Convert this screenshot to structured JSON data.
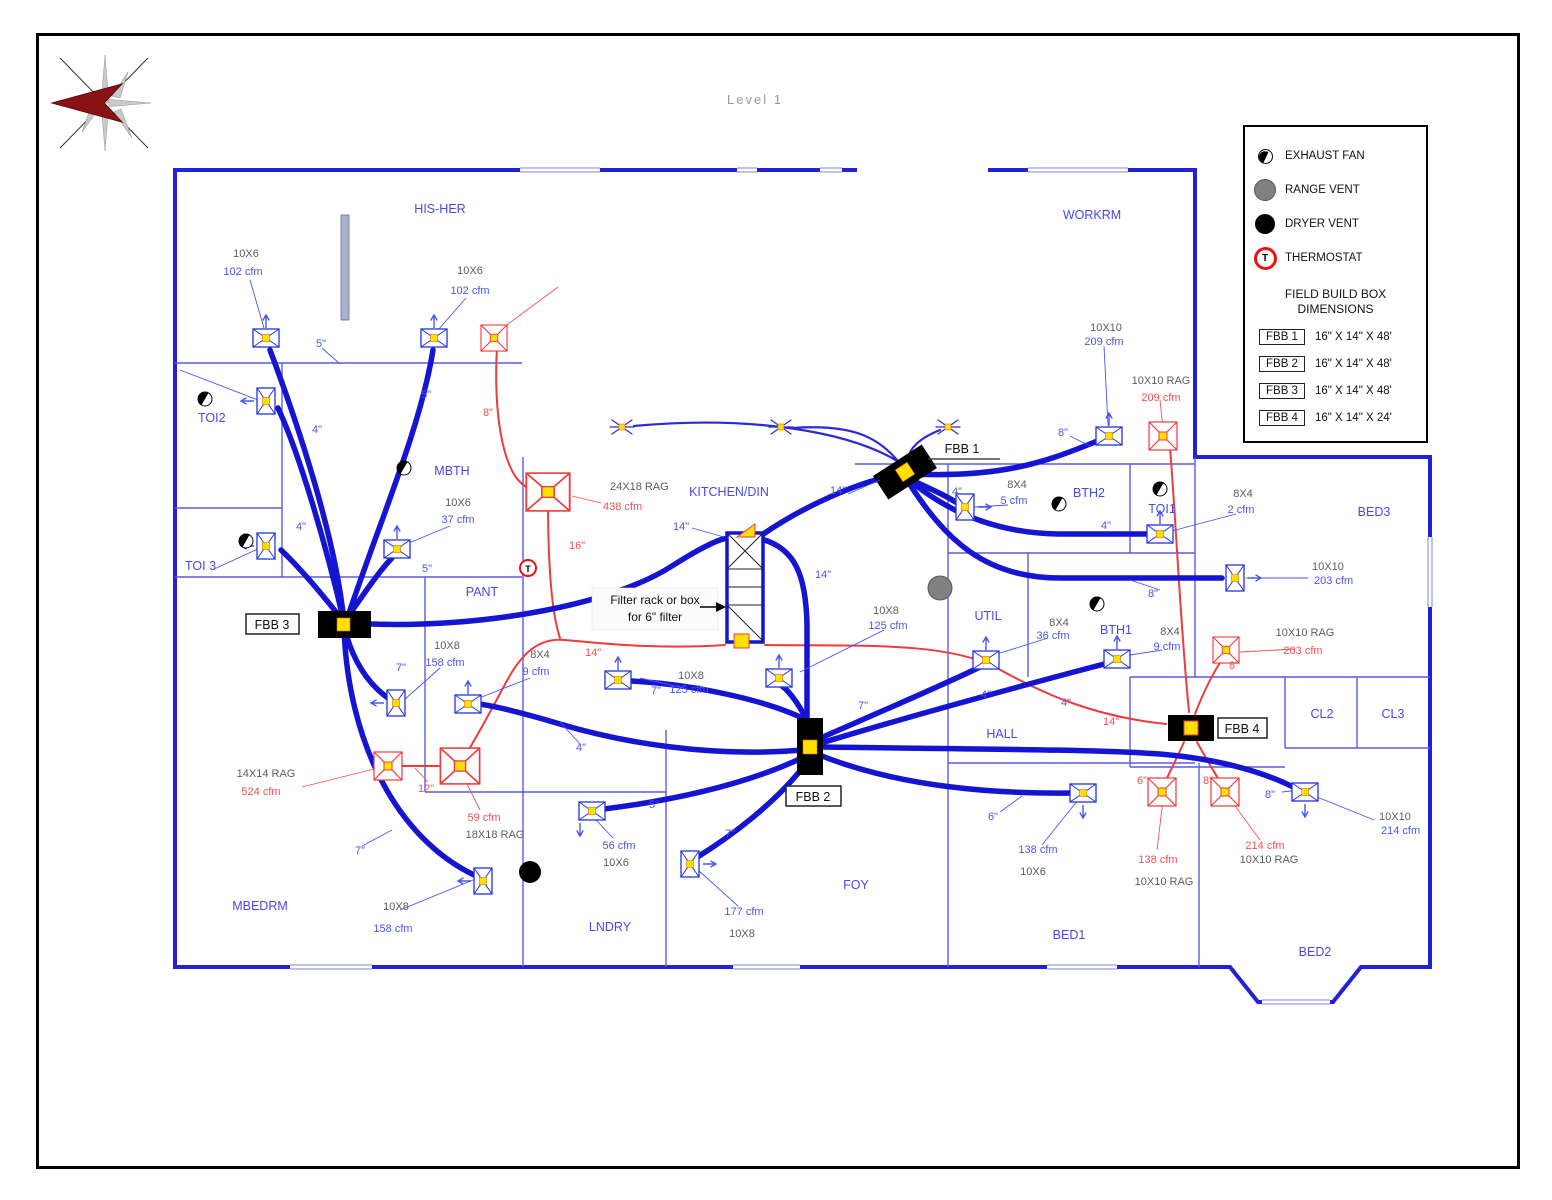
{
  "title": "Level 1",
  "colors": {
    "duct_blue": "#1414d2",
    "wall_blue": "#2121d9",
    "return_red": "#ee3b3b",
    "damper_yellow": "#ffe000"
  },
  "legend": {
    "items": [
      {
        "label": "EXHAUST FAN"
      },
      {
        "label": "RANGE VENT"
      },
      {
        "label": "DRYER VENT"
      },
      {
        "label": "THERMOSTAT"
      }
    ],
    "thermostat_letter": "T",
    "fbb_heading1": "FIELD BUILD BOX",
    "fbb_heading2": "DIMENSIONS",
    "fbb_rows": [
      {
        "tag": "FBB 1",
        "dim": "16\" X 14\" X 48'"
      },
      {
        "tag": "FBB 2",
        "dim": "16\" X 14\" X 48'"
      },
      {
        "tag": "FBB 3",
        "dim": "16\" X 14\" X 48'"
      },
      {
        "tag": "FBB 4",
        "dim": "16\" X 14\" X 24'"
      }
    ]
  },
  "rooms": [
    {
      "name": "HIS-HER"
    },
    {
      "name": "TOI2"
    },
    {
      "name": "TOI 3"
    },
    {
      "name": "MBTH"
    },
    {
      "name": "PANT"
    },
    {
      "name": "MBEDRM"
    },
    {
      "name": "LNDRY"
    },
    {
      "name": "KITCHEN/DIN"
    },
    {
      "name": "WORKRM"
    },
    {
      "name": "BTH2"
    },
    {
      "name": "TOI1"
    },
    {
      "name": "BED3"
    },
    {
      "name": "UTIL"
    },
    {
      "name": "BTH1"
    },
    {
      "name": "HALL"
    },
    {
      "name": "FOY"
    },
    {
      "name": "BED1"
    },
    {
      "name": "BED2"
    },
    {
      "name": "CL2"
    },
    {
      "name": "CL3"
    }
  ],
  "fbb_tags": [
    {
      "label": "FBB 1"
    },
    {
      "label": "FBB 2"
    },
    {
      "label": "FBB 3"
    },
    {
      "label": "FBB 4"
    }
  ],
  "note": {
    "line1": "Filter rack or box",
    "line2": "for 6\" filter"
  },
  "supplies": [
    {
      "size": "10X6",
      "cfm": "102 cfm"
    },
    {
      "size": "10X6",
      "cfm": "102 cfm"
    },
    {
      "size": "10X6",
      "cfm": "37 cfm"
    },
    {
      "size": "10X8",
      "cfm": "158 cfm"
    },
    {
      "size": "8X4",
      "cfm": "9 cfm"
    },
    {
      "size": "8X4",
      "cfm": "5 cfm"
    },
    {
      "size": "10X10",
      "cfm": "209 cfm"
    },
    {
      "size": "8X4",
      "cfm": "2 cfm"
    },
    {
      "size": "10X10",
      "cfm": "203 cfm"
    },
    {
      "size": "10X8",
      "cfm": "125 cfm"
    },
    {
      "size": "10X8",
      "cfm": "125 cfm"
    },
    {
      "size": "8X4",
      "cfm": "36 cfm"
    },
    {
      "size": "8X4",
      "cfm": "9 cfm"
    },
    {
      "size": "10X8",
      "cfm": "158 cfm"
    },
    {
      "size": "10X6",
      "cfm": "56 cfm"
    },
    {
      "size": "10X8",
      "cfm": "177 cfm"
    },
    {
      "size": "10X6",
      "cfm": "138 cfm"
    },
    {
      "size": "10X10",
      "cfm": "214 cfm"
    }
  ],
  "returns": [
    {
      "size": "24X18 RAG",
      "cfm": "438 cfm"
    },
    {
      "size": "10X10 RAG",
      "cfm": "209 cfm"
    },
    {
      "size": "10X10 RAG",
      "cfm": "203 cfm"
    },
    {
      "size": "14X14 RAG",
      "cfm": "524 cfm"
    },
    {
      "size": "18X18 RAG",
      "cfm": "59 cfm"
    },
    {
      "size": "10X10 RAG",
      "cfm": "138 cfm"
    },
    {
      "size": "10X10 RAG",
      "cfm": "214 cfm"
    }
  ],
  "duct_labels": [
    {
      "t": "5\""
    },
    {
      "t": "5\""
    },
    {
      "t": "4\""
    },
    {
      "t": "4\""
    },
    {
      "t": "5\""
    },
    {
      "t": "7\""
    },
    {
      "t": "7\""
    },
    {
      "t": "4\""
    },
    {
      "t": "12\""
    },
    {
      "t": "8\""
    },
    {
      "t": "16\""
    },
    {
      "t": "14\""
    },
    {
      "t": "14\""
    },
    {
      "t": "14\""
    },
    {
      "t": "14\""
    },
    {
      "t": "5\""
    },
    {
      "t": "7\""
    },
    {
      "t": "7\""
    },
    {
      "t": "7\""
    },
    {
      "t": "8\""
    },
    {
      "t": "4\""
    },
    {
      "t": "4\""
    },
    {
      "t": "8\""
    },
    {
      "t": "4\""
    },
    {
      "t": "4\""
    },
    {
      "t": "14\""
    },
    {
      "t": "8\""
    },
    {
      "t": "6\""
    },
    {
      "t": "8\""
    },
    {
      "t": "6\""
    },
    {
      "t": "8\""
    }
  ]
}
